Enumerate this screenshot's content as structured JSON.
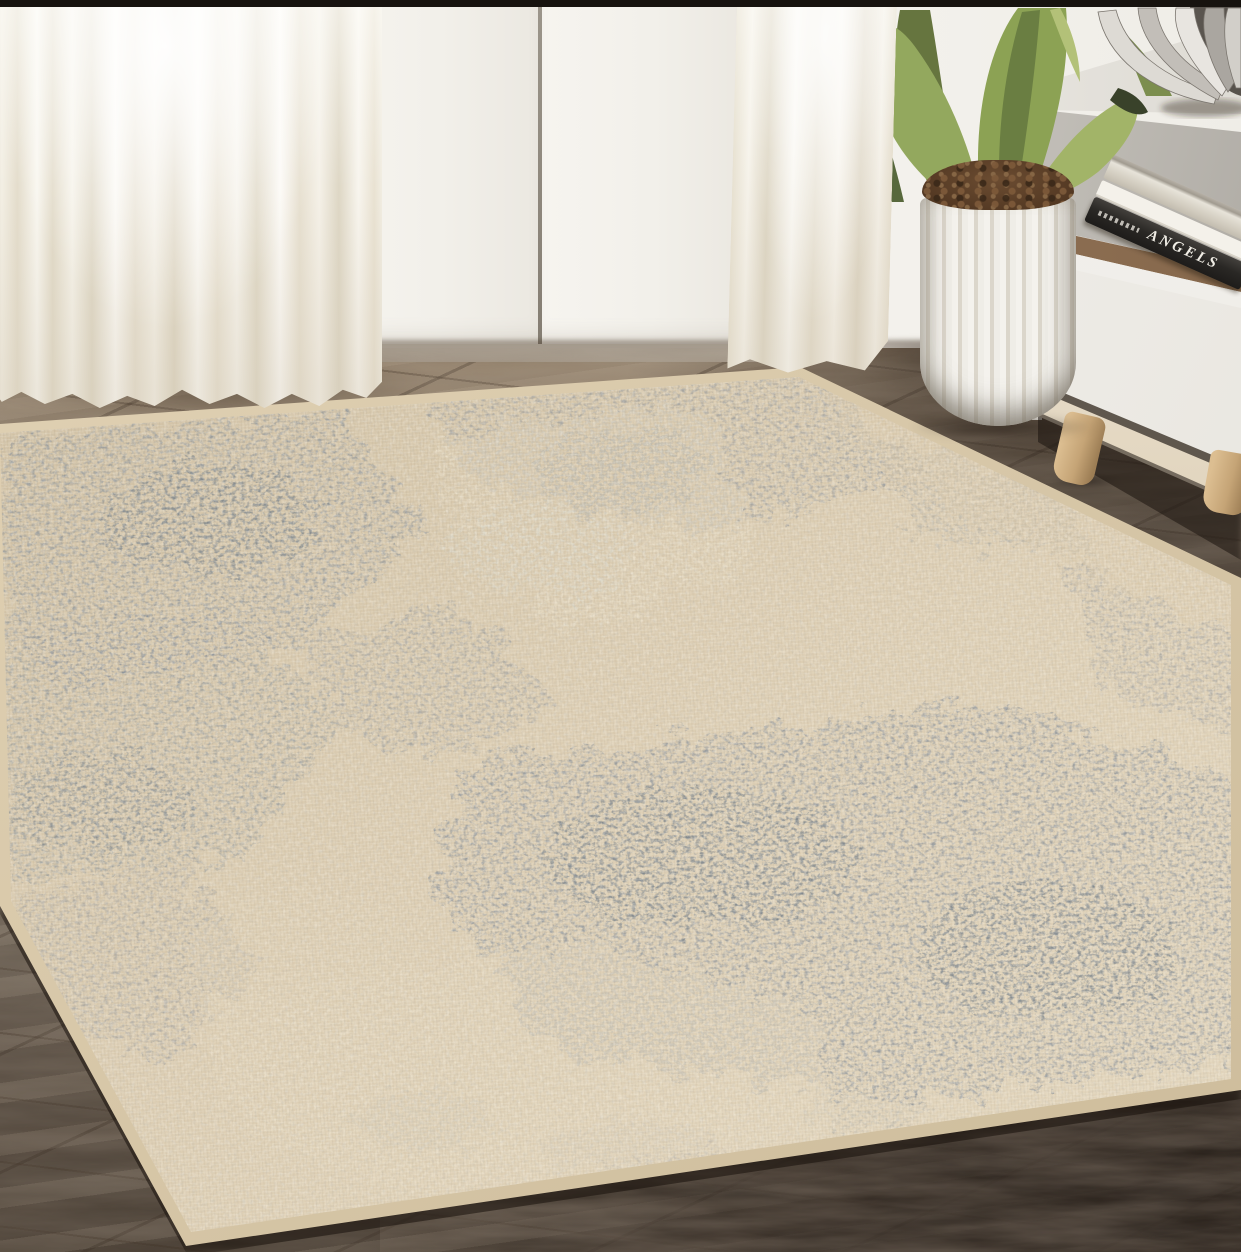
{
  "meta": {
    "type": "photograph",
    "subject": "Distressed abstract beige and gray-blue area rug staged in a bright living room"
  },
  "book": {
    "spine_text": "ANGELS"
  },
  "objects": [
    {
      "name": "area-rug",
      "label": "Distressed patchwork area rug, beige with gray-blue erosion patches and tan binding"
    },
    {
      "name": "wood-floor",
      "label": "Dark weathered wood plank floor"
    },
    {
      "name": "french-doors",
      "label": "White double doors with glass panes"
    },
    {
      "name": "sheer-curtain-left",
      "label": "White sheer curtain, left"
    },
    {
      "name": "sheer-curtain-right",
      "label": "White sheer curtain, right"
    },
    {
      "name": "sideboard",
      "label": "White cabinet with open shelf, drawer and splayed wood legs"
    },
    {
      "name": "book-stack",
      "label": "Stack of books on shelf, bottom spine reads ANGELS"
    },
    {
      "name": "decor-bowl",
      "label": "Silver sculptural bowl on cabinet top"
    },
    {
      "name": "agave-plant",
      "label": "Green agave plant"
    },
    {
      "name": "fluted-planter",
      "label": "White fluted cylindrical planter with soil"
    }
  ],
  "palette": {
    "rug_base_beige": "#d9cab0",
    "rug_gray_blue": "#87909a",
    "rug_binding_tan": "#d6c5a5",
    "floor_light": "#9a8872",
    "floor_dark": "#453b31",
    "wall_white": "#f2f0ea",
    "leaf_green": "#8ca254",
    "wood_leg": "#c5a476",
    "book_black": "#2a2825",
    "bowl_silver": "#d2cfc9"
  }
}
